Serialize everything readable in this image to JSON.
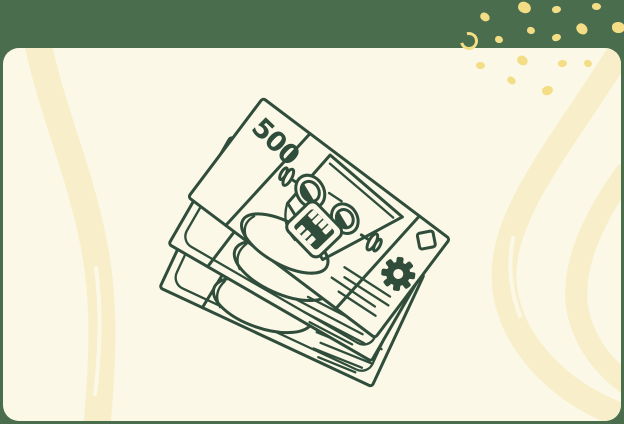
{
  "palette": {
    "background_green": "#4A6D4E",
    "panel_cream": "#FBF8E8",
    "brush_yellow": "#F8EFCA",
    "confetti_yellow": "#F3DD85",
    "line_green": "#2F4D3A"
  },
  "illustration": {
    "name": "stack-of-banknotes-with-robot-face",
    "denomination": "500",
    "elements": [
      "banknote-stack",
      "robot-face",
      "goggle-eyes",
      "teeth-mouth",
      "side-bolts",
      "gear-icon",
      "diamond-mark",
      "hatch-lines",
      "portrait-ovals"
    ]
  },
  "decor": {
    "confetti_count": 16,
    "brush_strokes": [
      "left-vertical-stroke",
      "right-outer-curve",
      "right-inner-curve"
    ]
  }
}
